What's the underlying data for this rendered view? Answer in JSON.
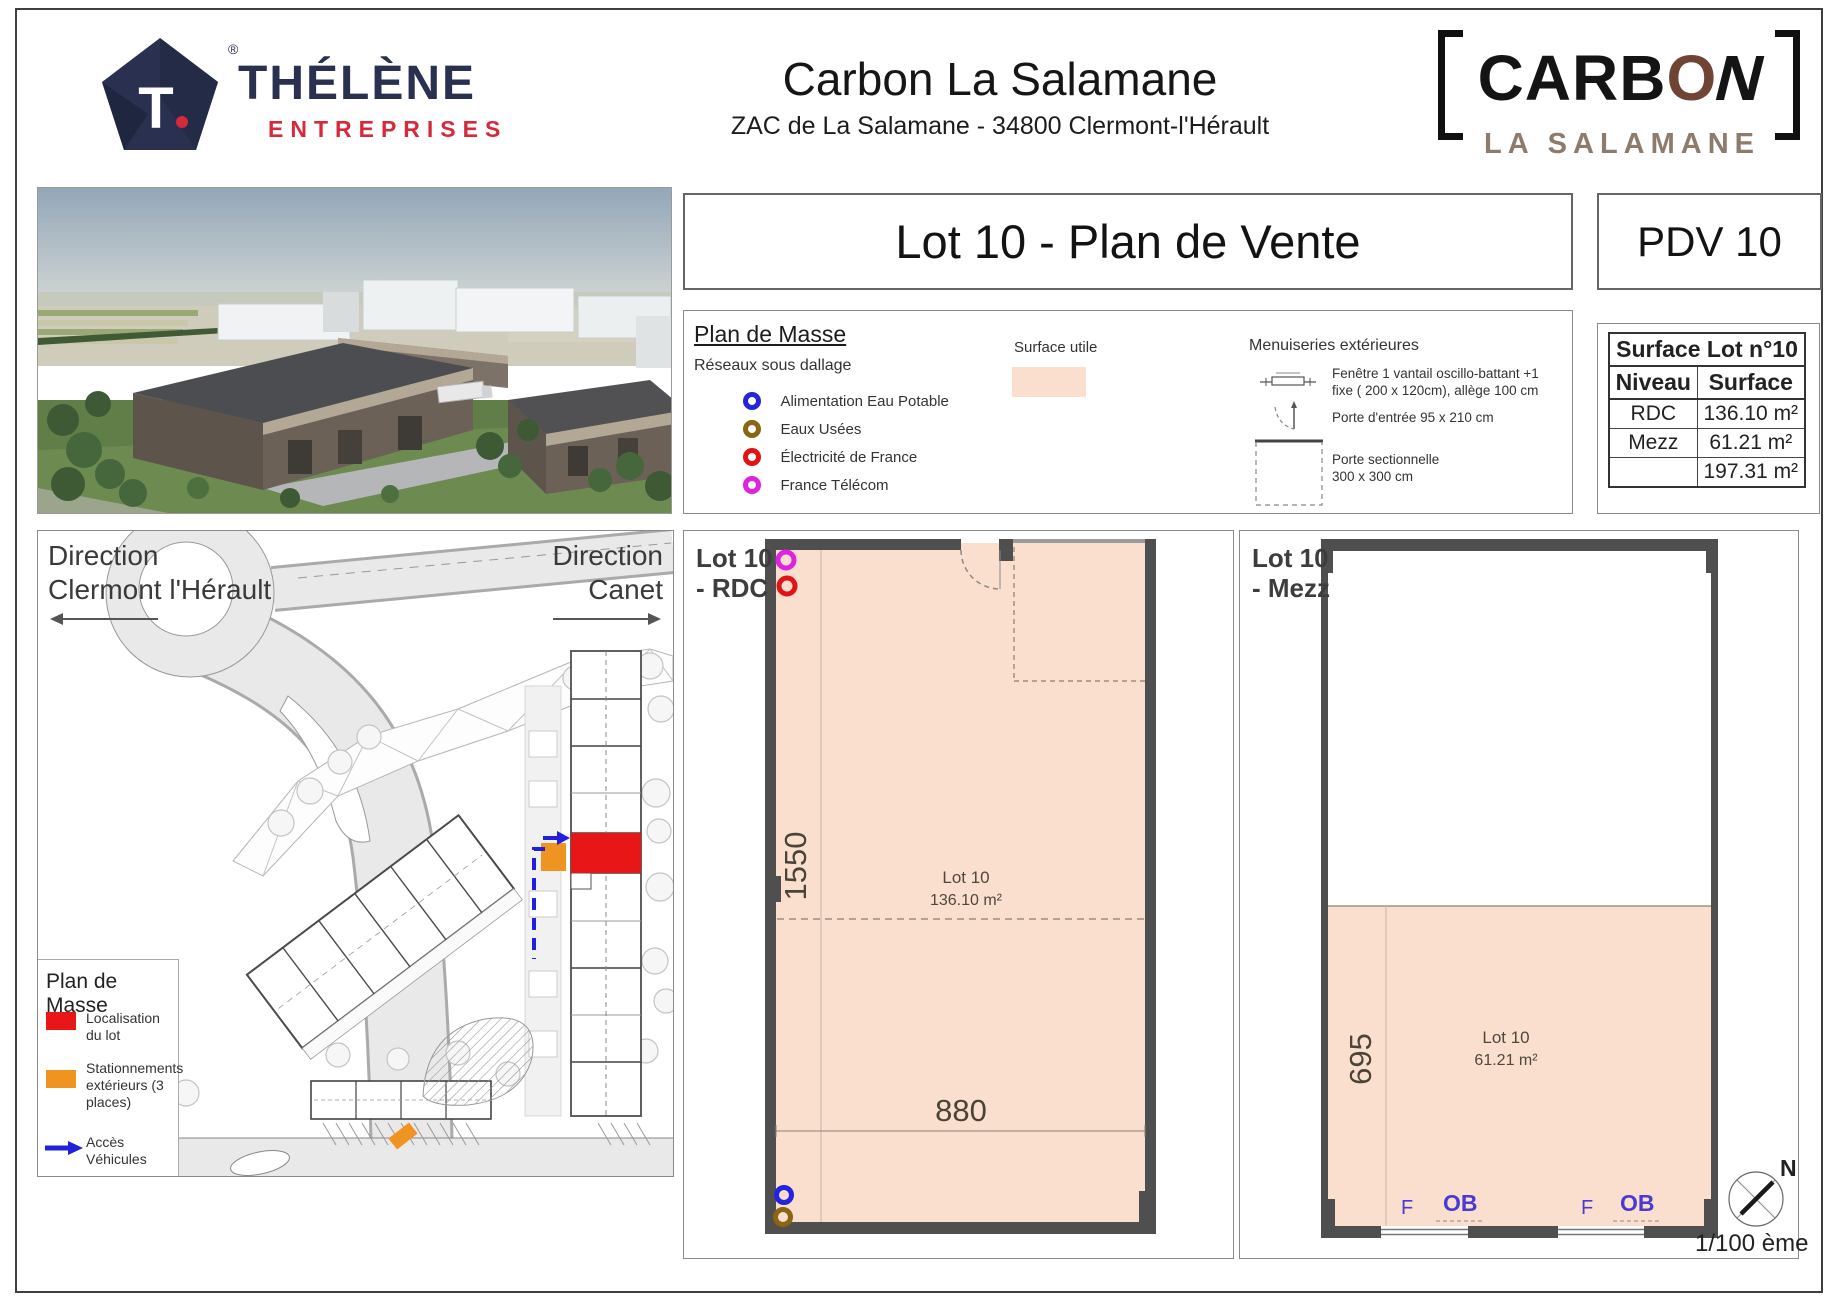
{
  "page": {
    "trademark": "®"
  },
  "header": {
    "thelene": {
      "word": "THÉLÈNE",
      "sub": "ENTREPRISES",
      "mono_t": "T",
      "mono_dot": "."
    },
    "title": "Carbon La Salamane",
    "subtitle": "ZAC de La Salamane - 34800 Clermont-l'Hérault",
    "carbon": {
      "part1": "CARB",
      "o": "O",
      "part2": "N",
      "sub": "LA SALAMANE"
    },
    "plan_title": "Lot 10 - Plan de Vente",
    "pdv": "PDV 10"
  },
  "legend": {
    "title": "Plan de Masse",
    "networks_title": "Réseaux sous dallage",
    "items": [
      {
        "label": "Alimentation Eau Potable",
        "color": "#2424e0"
      },
      {
        "label": "Eaux Usées",
        "color": "#8a6612"
      },
      {
        "label": "Électricité de France",
        "color": "#e01414"
      },
      {
        "label": "France Télécom",
        "color": "#e022e0"
      }
    ],
    "surface_utile": {
      "label": "Surface utile",
      "color": "#fbdfce"
    },
    "menuiseries": {
      "title": "Menuiseries extérieures",
      "item1_line1": "Fenêtre 1 vantail oscillo-battant +1",
      "item1_line2": "fixe ( 200 x 120cm), allège 100 cm",
      "item2": "Porte d'entrée 95 x 210 cm",
      "item3_line1": "Porte sectionnelle",
      "item3_line2": "300 x 300 cm"
    }
  },
  "surface_table": {
    "title": "Surface Lot n°10",
    "columns": [
      "Niveau",
      "Surface"
    ],
    "rows": [
      [
        "RDC",
        "136.10 m²"
      ],
      [
        "Mezz",
        "61.21 m²"
      ],
      [
        "",
        "197.31 m²"
      ]
    ]
  },
  "site_map": {
    "direction_left_line1": "Direction",
    "direction_left_line2": "Clermont l'Hérault",
    "direction_right_line1": "Direction",
    "direction_right_line2": "Canet",
    "legend_title": "Plan de Masse",
    "legend_items": [
      {
        "label": "Localisation du lot",
        "color": "#e81616"
      },
      {
        "label": "Stationnements extérieurs (3 places)",
        "color": "#ef9420"
      },
      {
        "label": "Accès Véhicules",
        "color": "#2020dd"
      }
    ]
  },
  "rdc_plan": {
    "label_line1": "Lot 10",
    "label_line2": "- RDC",
    "lot_name": "Lot 10",
    "area": "136.10 m²",
    "dim_v": "1550",
    "dim_h": "880"
  },
  "mezz_plan": {
    "label_line1": "Lot 10",
    "label_line2": "- Mezz",
    "lot_name": "Lot 10",
    "area": "61.21 m²",
    "dim_v": "695",
    "windows": [
      "F",
      "OB",
      "F",
      "OB"
    ]
  },
  "footer": {
    "north": "N",
    "scale": "1/100 ème"
  },
  "colors": {
    "peach": "#fbdfce",
    "wall": "#4f4f4f",
    "lot_red": "#e81616",
    "parking_orange": "#ef9420",
    "access_blue": "#2020dd"
  }
}
